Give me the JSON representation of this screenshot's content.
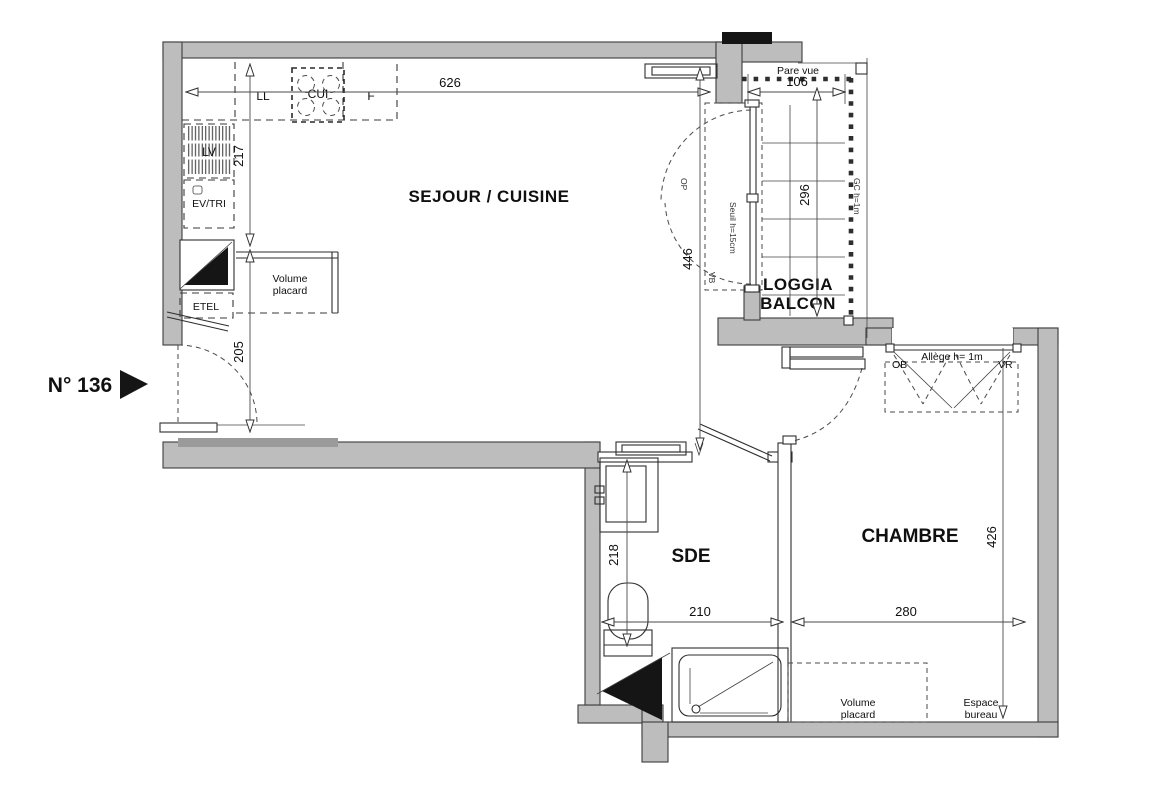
{
  "plan": {
    "unit_label": "N° 136",
    "rooms": {
      "sejour": "SEJOUR / CUISINE",
      "loggia_line1": "LOGGIA",
      "loggia_line2": "BALCON",
      "sde": "SDE",
      "chambre": "CHAMBRE"
    },
    "dims": {
      "d626": "626",
      "d217": "217",
      "d205": "205",
      "d446": "446",
      "d106": "106",
      "d296": "296",
      "d218": "218",
      "d210": "210",
      "d280": "280",
      "d426": "426"
    },
    "appliances": {
      "ll": "LL",
      "cui": "CUI",
      "f": "F",
      "lv": "LV",
      "ev_tri": "EV/TRI",
      "etel": "ETEL"
    },
    "annotations": {
      "volume_1": "Volume",
      "volume_2": "placard",
      "espace_1": "Espace",
      "espace_2": "bureau",
      "pare_vue": "Pare vue",
      "gc": "GC h=1m",
      "seuil": "Seuil h=15cm",
      "allege": "Allège h= 1m",
      "op": "OP",
      "vb": "VB",
      "ob": "OB",
      "vr": "VR"
    }
  },
  "colors": {
    "background": "#ffffff",
    "wall_fill": "#bdbdbd",
    "wall_dark": "#9a9a9a",
    "line": "#2e2e2e",
    "text": "#101010",
    "solid_black": "#151515"
  }
}
